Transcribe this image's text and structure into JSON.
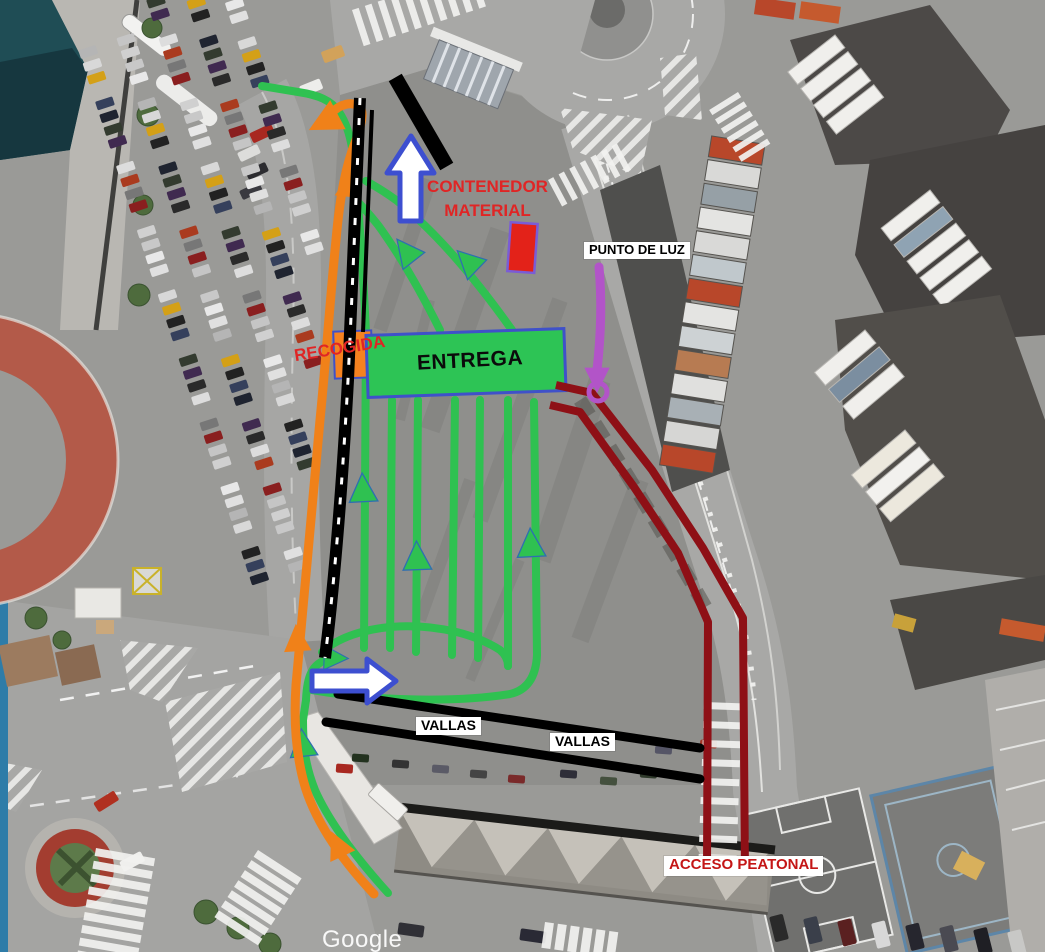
{
  "map": {
    "type": "satellite-annotated-operations-plan",
    "watermark": "Google"
  },
  "labels": {
    "contenedor_material": {
      "line1": "CONTENEDOR",
      "line2": "MATERIAL"
    },
    "punto_de_luz": "PUNTO DE LUZ",
    "recogida": "RECOGIDA",
    "entrega": "ENTREGA",
    "vallas_left": "VALLAS",
    "vallas_right": "VALLAS",
    "acceso_peatonal": "ACCESO PEATONAL"
  },
  "colors": {
    "route_orange": "#f08119",
    "route_green": "#2fc151",
    "route_dark_red": "#8e1016",
    "fence_black": "#000000",
    "marker_purple": "#b254c8",
    "arrow_outline_blue": "#3d4fd0",
    "arrow_fill_white": "#ffffff",
    "entrega_fill": "#2dc455",
    "recogida_fill": "#f58220",
    "container_red_fill": "#e32219",
    "label_red": "#e02525",
    "acceso_red": "#c41616",
    "label_bg_white": "#ffffff"
  }
}
